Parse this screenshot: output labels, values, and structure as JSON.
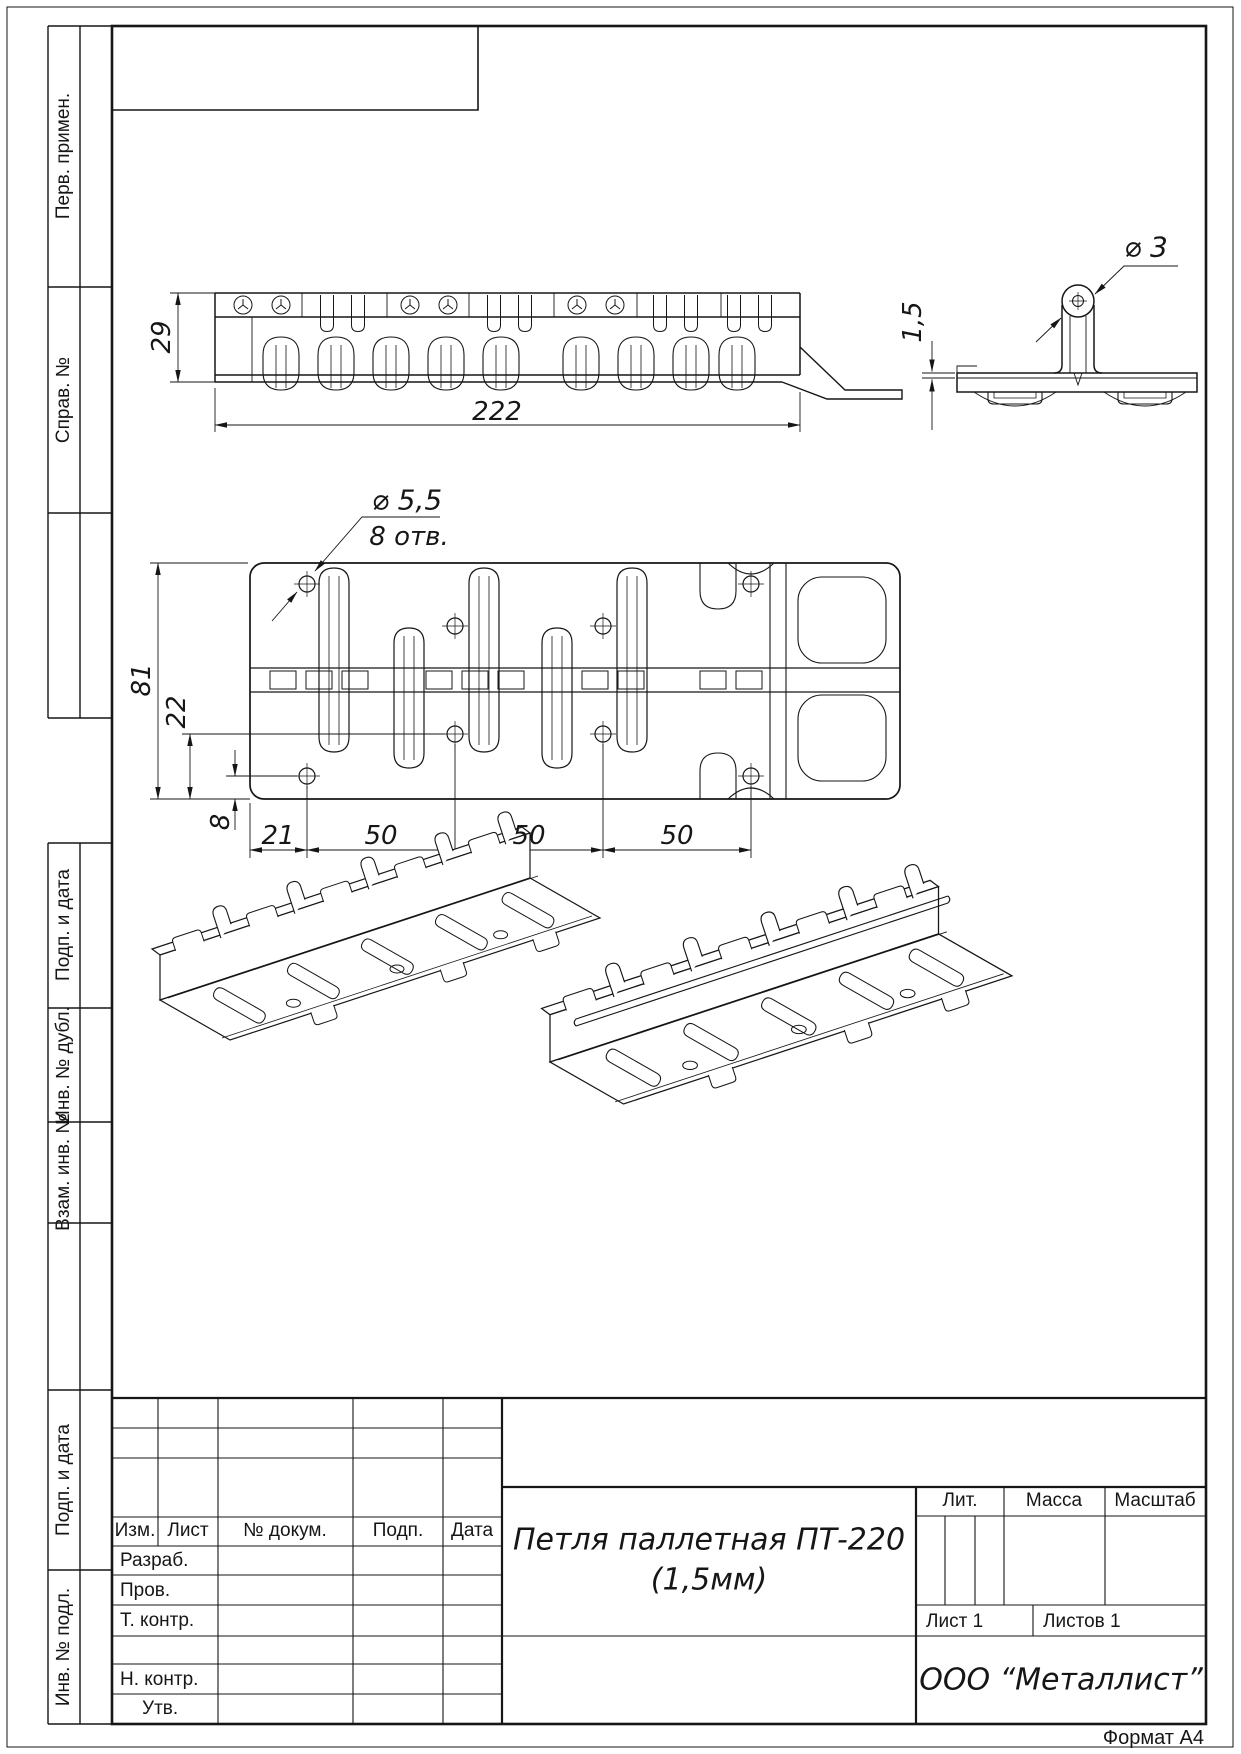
{
  "left_margin": {
    "labels": [
      "Перв. примен.",
      "Справ. №",
      "Подп. и дата",
      "Инв. № дубл.",
      "Взам. инв. №",
      "Подп. и дата",
      "Инв. № подл."
    ]
  },
  "dimensions": {
    "front_height": "29",
    "front_length": "222",
    "sheet_thickness": "1,5",
    "pin_diameter": "⌀ 3",
    "hole_diameter": "⌀ 5,5",
    "hole_count": "8 отв.",
    "plan_width": "81",
    "inner_hole_offset": "22",
    "outer_hole_offset": "8",
    "edge_to_first_hole": "21",
    "pitch1": "50",
    "pitch2": "50",
    "pitch3": "50"
  },
  "title_block": {
    "change_cols": [
      "Изм.",
      "Лист",
      "№ докум.",
      "Подп.",
      "Дата"
    ],
    "sign_rows": [
      "Разраб.",
      "Пров.",
      "Т. контр.",
      "",
      "Н. контр.",
      "Утв."
    ],
    "title_line1": "Петля паллетная ПТ-220",
    "title_line2": "(1,5мм)",
    "lit_label": "Лит.",
    "mass_label": "Масса",
    "scale_label": "Масштаб",
    "sheet_info": "Лист 1",
    "sheets_info": "Листов 1",
    "company": "ООО “Металлист”",
    "format_note": "Формат А4"
  }
}
